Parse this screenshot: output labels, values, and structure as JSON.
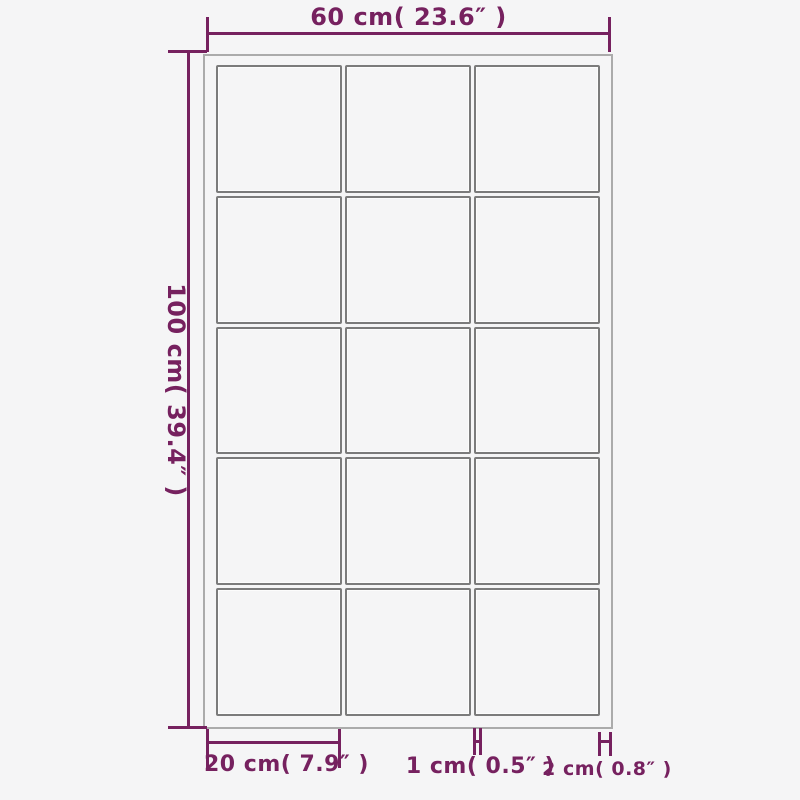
{
  "diagram": {
    "product": "grid-mirror",
    "grid": {
      "columns": 3,
      "rows": 5,
      "panes": 15
    },
    "dimensions": {
      "total_width": {
        "label": "60 cm( 23.6″ )"
      },
      "total_height": {
        "label": "100 cm( 39.4″ )"
      },
      "pane_width": {
        "label": "20 cm( 7.9″ )"
      },
      "mullion_width": {
        "label": "1 cm( 0.5″ )"
      },
      "frame_depth": {
        "label": "2 cm( 0.8″ )"
      }
    },
    "colors": {
      "annotation": "#76215f",
      "frame_border": "#ababab",
      "pane_border": "#7b7b7b",
      "background": "#f5f5f6"
    }
  }
}
